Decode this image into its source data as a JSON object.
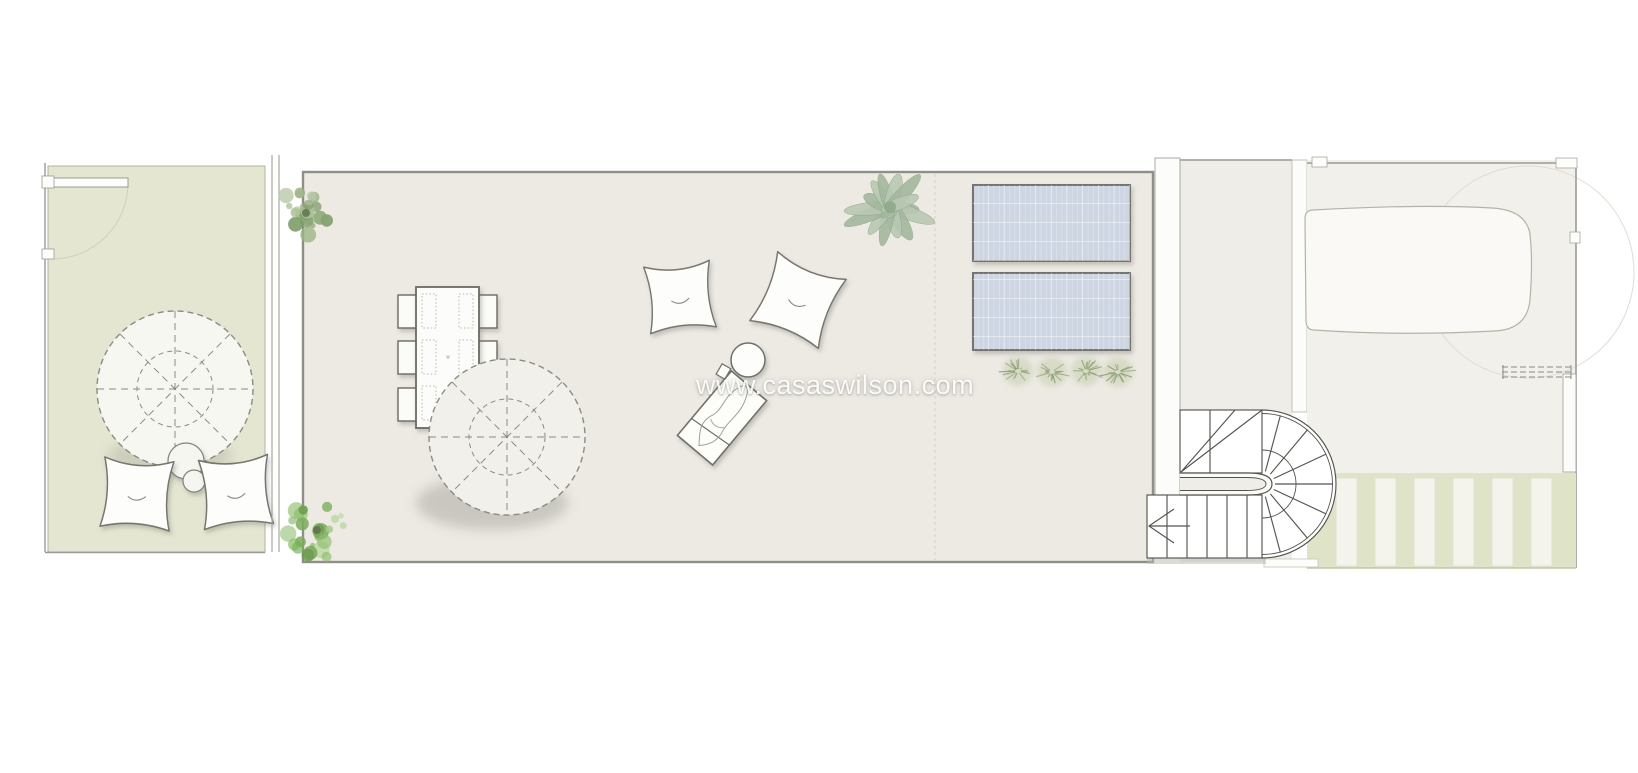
{
  "watermark": {
    "text": "www.casaswilson.com"
  },
  "palette": {
    "page_background": "#ffffff",
    "garden_green": "#e4e6d1",
    "terrace_beige": "#edeae4",
    "landing_beige": "#efede8",
    "right_area_cream": "#f2f0eb",
    "pergola_green": "#dfe3c8",
    "solar_panel_blue": "#cfd6e3",
    "foliage_green": "#8fae77",
    "line_dark": "#55554f",
    "wall_gray": "#9a9a94"
  }
}
